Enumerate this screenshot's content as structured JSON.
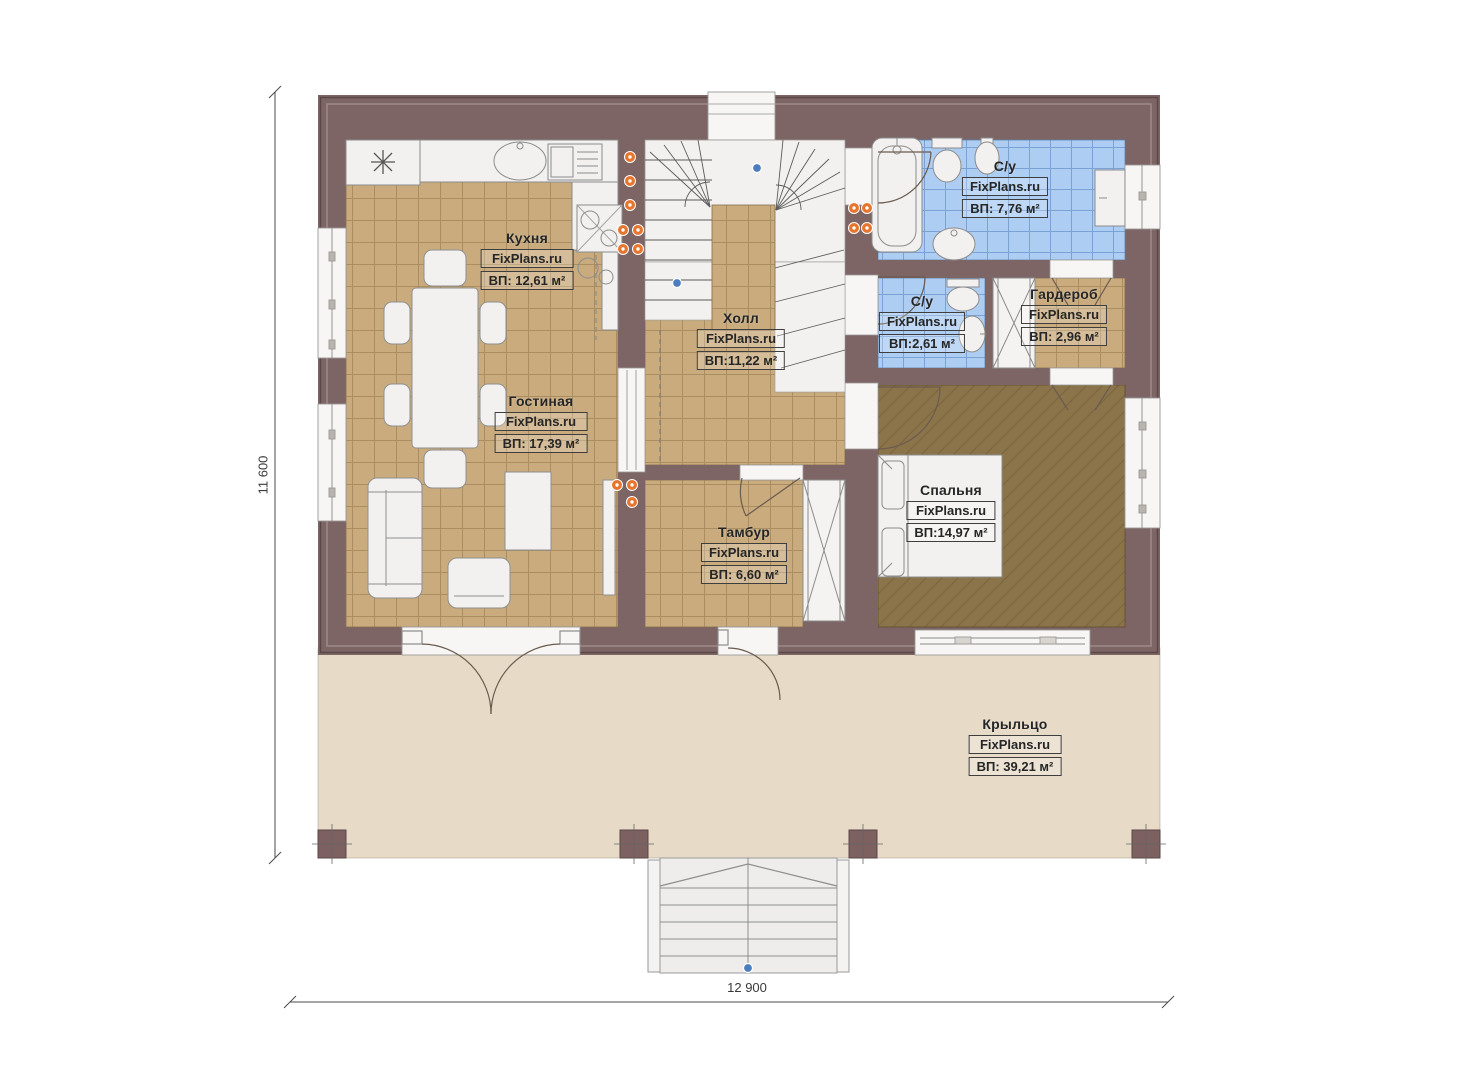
{
  "plan": {
    "title": "floor-plan",
    "brand": "FixPlans.ru",
    "rooms": {
      "kitchen": {
        "name": "Кухня",
        "brand": "FixPlans.ru",
        "area": "ВП: 12,61 м²"
      },
      "hall": {
        "name": "Холл",
        "brand": "FixPlans.ru",
        "area": "ВП:11,22 м²"
      },
      "living": {
        "name": "Гостиная",
        "brand": "FixPlans.ru",
        "area": "ВП: 17,39 м²"
      },
      "vestibule": {
        "name": "Тамбур",
        "brand": "FixPlans.ru",
        "area": "ВП: 6,60 м²"
      },
      "bath_main": {
        "name": "С/у",
        "brand": "FixPlans.ru",
        "area": "ВП: 7,76 м²"
      },
      "bath_small": {
        "name": "С/у",
        "brand": "FixPlans.ru",
        "area": "ВП:2,61 м²"
      },
      "wardrobe": {
        "name": "Гардероб",
        "brand": "FixPlans.ru",
        "area": "ВП: 2,96 м²"
      },
      "bedroom": {
        "name": "Спальня",
        "brand": "FixPlans.ru",
        "area": "ВП:14,97 м²"
      },
      "porch": {
        "name": "Крыльцо",
        "brand": "FixPlans.ru",
        "area": "ВП: 39,21 м²"
      }
    },
    "dimensions": {
      "overall_width": "12 900",
      "overall_height": "11 600"
    },
    "colors": {
      "wall": "#7d6565",
      "floor_tile_tan": "#c9ab7d",
      "floor_tile_blue": "#aecdf2",
      "floor_bedroom": "#8b744a",
      "porch": "#e7dbc8",
      "fixture_white": "#f2f1ef",
      "socket_orange": "#e8752e",
      "marker_blue": "#4a7ec0"
    }
  }
}
